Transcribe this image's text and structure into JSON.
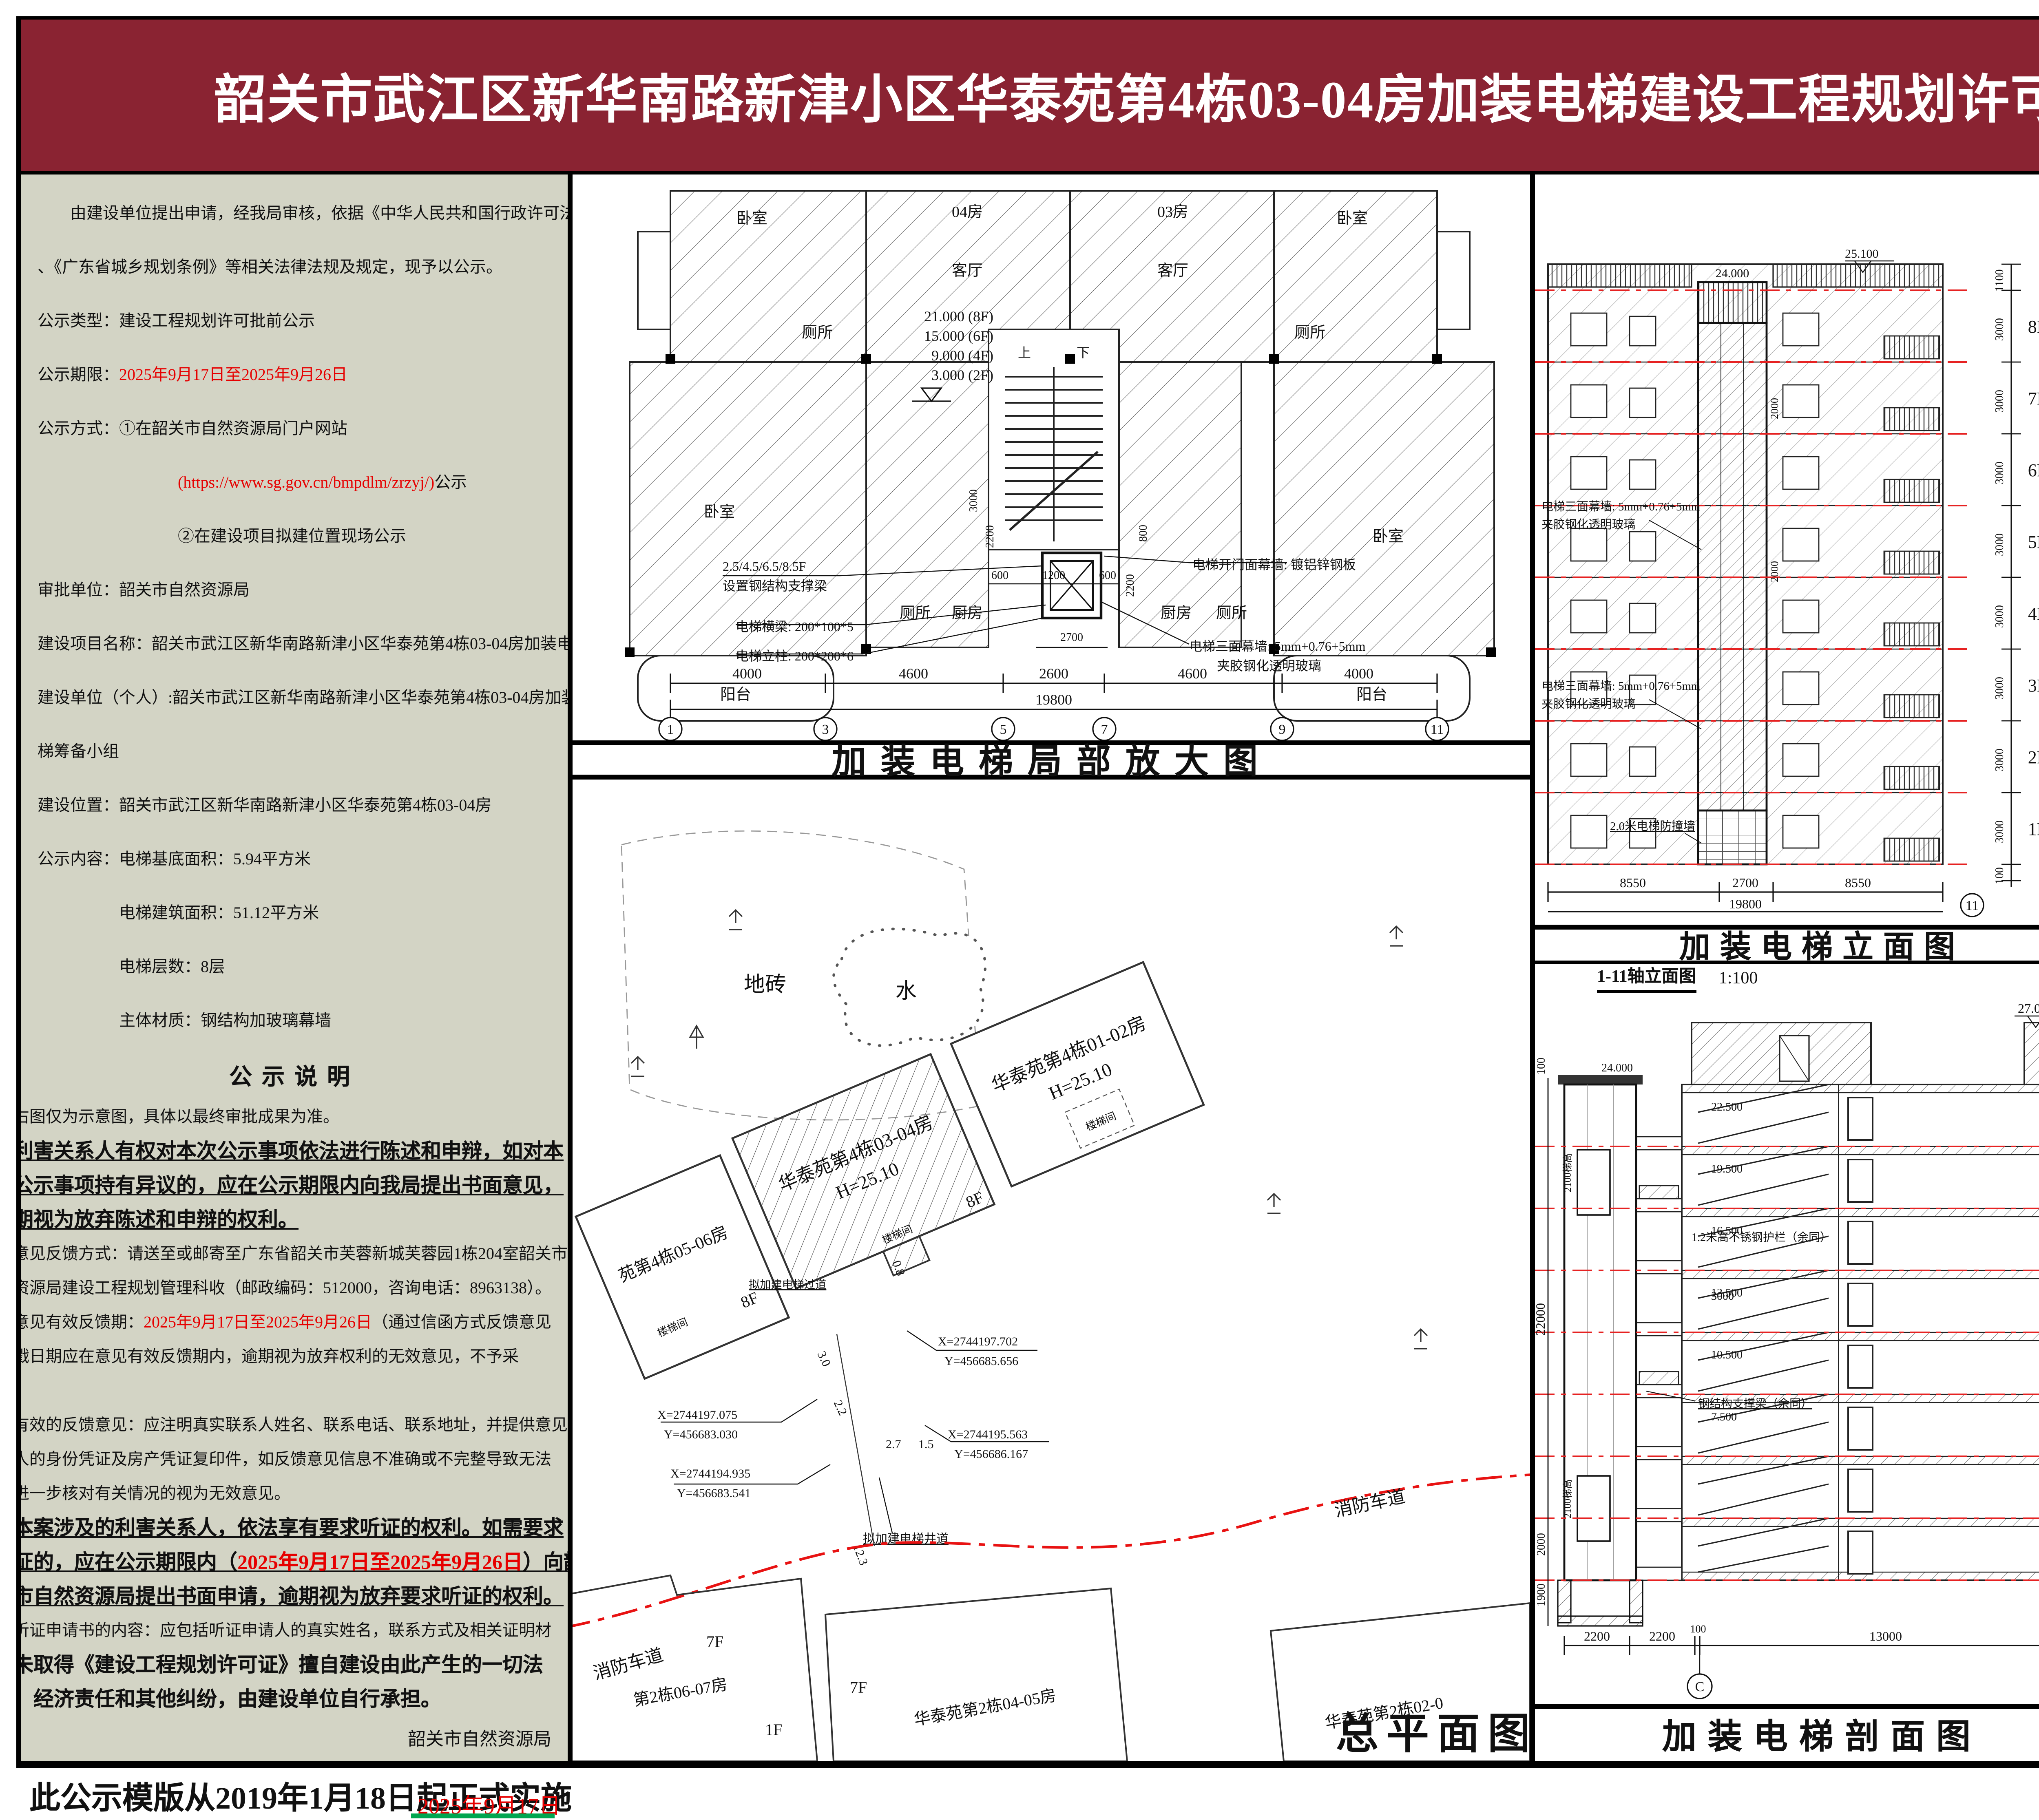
{
  "banner": {
    "title": "韶关市武江区新华南路新津小区华泰苑第4栋03-04房加装电梯建设工程规划许可批前公示(一)"
  },
  "notice": {
    "p1a": "由建设单位提出申请，经我局审核，依据《中华人民共和国行政许可法》",
    "p1b": "、《广东省城乡规划条例》等相关法律法规及规定，现予以公示。",
    "type": "公示类型：建设工程规划许可批前公示",
    "period_label": "公示期限：",
    "period_date": "2025年9月17日至2025年9月26日",
    "method1": "公示方式：①在韶关市自然资源局门户网站",
    "method_url": "(https://www.sg.gov.cn/bmpdlm/zrzyj/)",
    "method_url_tail": "公示",
    "method2": "②在建设项目拟建位置现场公示",
    "approval": "审批单位：韶关市自然资源局",
    "project": "建设项目名称：韶关市武江区新华南路新津小区华泰苑第4栋03-04房加装电梯",
    "owner1": "建设单位（个人）:韶关市武江区新华南路新津小区华泰苑第4栋03-04房加装电",
    "owner2": "梯筹备小组",
    "location": "建设位置：韶关市武江区新华南路新津小区华泰苑第4栋03-04房",
    "content1": "公示内容：电梯基底面积：5.94平方米",
    "content2": "电梯建筑面积：51.12平方米",
    "content3": "电梯层数：8层",
    "content4": "主体材质：钢结构加玻璃幕墙"
  },
  "statement": {
    "heading": "公示说明",
    "s1": "右图仅为示意图，具体以最终审批成果为准。",
    "s2a": "利害关系人有权对本次公示事项依法进行陈述和申辩，如对本",
    "s2b": "公示事项持有异议的，应在公示期限内向我局提出书面意见，",
    "s2c": "期视为放弃陈述和申辩的权利。",
    "s3a": "意见反馈方式：请送至或邮寄至广东省韶关市芙蓉新城芙蓉园1栋204室韶关市",
    "s3b": "资源局建设工程规划管理科收（邮政编码：512000，咨询电话：8963138）。",
    "s4_label": "意见有效反馈期：",
    "s4_date": "2025年9月17日至2025年9月26日",
    "s4_tail": "（通过信函方式反馈意见",
    "s4b": "戳日期应在意见有效反馈期内，逾期视为放弃权利的无效意见，不予采",
    "s4c": "。",
    "s5a": "有效的反馈意见：应注明真实联系人姓名、联系电话、联系地址，并提供意见",
    "s5b": "人的身份凭证及房产凭证复印件，如反馈意见信息不准确或不完整导致无法",
    "s5c": "进一步核对有关情况的视为无效意见。",
    "s6a": "本案涉及的利害关系人，依法享有要求听证的权利。如需要求",
    "s6b_pre": "证的，应在公示期限内（",
    "s6b_date": "2025年9月17日至2025年9月26日",
    "s6b_tail": "）向韶",
    "s6c": "市自然资源局提出书面申请，逾期视为放弃要求听证的权利。",
    "s7": "听证申请书的内容：应包括听证申请人的真实姓名，联系方式及相关证明材",
    "s8a": "未取得《建设工程规划许可证》擅自建设由此产生的一切法",
    "s8b": "　经济责任和其他纠纷，由建设单位自行承担。",
    "sign": "韶关市自然资源局"
  },
  "floor_plan": {
    "title": "加装电梯局部放大图",
    "rooms": {
      "bed_tl": "卧室",
      "unit04": "04房",
      "unit03": "03房",
      "living_l": "客厅",
      "living_r": "客厅",
      "bed_tr": "卧室",
      "wc_tl": "厕所",
      "wc_tr": "厕所",
      "bed_ml": "卧室",
      "bed_mr": "卧室",
      "wc_bl": "厕所",
      "kitchen_l": "厨房",
      "kitchen_r": "厨房",
      "wc_br": "厕所",
      "balcony_l": "阳台",
      "balcony_r": "阳台"
    },
    "levels": [
      "21.000 (8F)",
      "15.000 (6F)",
      "9.000 (4F)",
      "3.000 (2F)"
    ],
    "stair_up": "上",
    "stair_down": "下",
    "ann_floors": "2.5/4.5/6.5/8.5F",
    "ann_floors2": "设置钢结构支撑梁",
    "ann_door": "电梯开门面幕墙: 镀铝锌钢板",
    "ann_beam": "电梯横梁: 200*100*5",
    "ann_col": "电梯立柱: 200*200*6",
    "ann_glass1": "电梯三面幕墙: 5mm+0.76+5mm",
    "ann_glass2": "夹胶钢化透明玻璃",
    "dim_600a": "600",
    "dim_1200": "1200",
    "dim_600b": "600",
    "dim_2700": "2700",
    "dim_2200l": "2200",
    "dim_2200r": "2200",
    "dim_3000": "3000",
    "dim_800": "800",
    "axis_dims": [
      "4000",
      "4600",
      "2600",
      "4600",
      "4000"
    ],
    "total": "19800",
    "axes": [
      "1",
      "3",
      "5",
      "7",
      "9",
      "11"
    ]
  },
  "elevation": {
    "title": "加装电梯立面图",
    "subtitle": "1-11轴立面图",
    "scale": "1:100",
    "shaft_top": "24.000",
    "roof": "25.100",
    "flags": [
      "25.100",
      "24.000",
      "21.000",
      "18.000",
      "15.000",
      "12.000",
      "9.000",
      "6.000",
      "3.000",
      "±0.000",
      "-0.100"
    ],
    "floors": [
      "8F",
      "7F",
      "6F",
      "5F",
      "4F",
      "3F",
      "2F",
      "1F"
    ],
    "dim_1100": "1100",
    "dim_3000": "3000",
    "dim_100": "100",
    "dim_2000": "2000",
    "glass1": "电梯三面幕墙: 5mm+0.76+5mm",
    "glass2": "夹胶钢化透明玻璃",
    "wall": "2.0米电梯防撞墙",
    "bottom_dims": [
      "8550",
      "2700",
      "8550"
    ],
    "total": "19800",
    "axis": "11"
  },
  "section": {
    "title": "加装电梯剖面图",
    "top": "27.000",
    "left_top": "24.000",
    "landings": [
      "22.500",
      "19.500",
      "16.500",
      "13.500",
      "10.500",
      "7.500"
    ],
    "d1100": "1100",
    "d3000": "3000",
    "d100": "100",
    "l100": "100",
    "l22000": "22000",
    "l2000": "2000",
    "l1900": "1900",
    "car_dim": "2100梯高",
    "ann_beam": "钢结构支撑梁（余同）",
    "ann_rail": "1.2米高不锈钢护栏（余同）",
    "ann_3000": "3000",
    "bottom_dims": [
      "2200",
      "2200",
      "100",
      "13000",
      "100"
    ],
    "axes": [
      "C",
      "A"
    ]
  },
  "site_plan": {
    "title": "总平面图",
    "ground": "地砖",
    "water": "水",
    "b0102": "华泰苑第4栋01-02房",
    "b0102_h": "H=25.10",
    "b0304": "华泰苑第4栋03-04房",
    "b0304_h": "H=25.10",
    "b0506": "苑第4栋05-06房",
    "b0607": "第2栋06-07房",
    "b0405": "华泰苑第2栋04-05房",
    "b0201": "华泰苑第2栋02-0",
    "stair": "楼梯间",
    "f8": "8F",
    "f7": "7F",
    "f1": "1F",
    "fire_lane": "消防车道",
    "corridor": "拟加建电梯过道",
    "shaft": "拟加建电梯井道",
    "coords": [
      {
        "x": "X=2744197.702",
        "y": "Y=456685.656"
      },
      {
        "x": "X=2744197.075",
        "y": "Y=456683.030"
      },
      {
        "x": "X=2744195.563",
        "y": "Y=456686.167"
      },
      {
        "x": "X=2744194.935",
        "y": "Y=456683.541"
      }
    ],
    "dims": {
      "d30": "3.0",
      "d22": "2.2",
      "d27": "2.7",
      "d15": "1.5",
      "d123": "12.3",
      "d08": "0.8"
    }
  },
  "compass": {
    "north": "N",
    "ticks": [
      "0",
      "5",
      "10",
      "20m"
    ]
  },
  "map": {
    "baogailing": "宝盖岭",
    "hotel1": "韶关曼哈顿国",
    "hotel2": "际酒店附近",
    "xinxing": "新兴路",
    "fukang": "富康广场",
    "gongyezhong": "工业中路",
    "gongyedong": "工业东路",
    "huatai": "华泰花园",
    "project": "项目位置",
    "baiwei": "佰味楼附近",
    "yihua": "怡华路",
    "moer": "关摩尔城",
    "shiji": "世纪购物"
  },
  "legend": {
    "main": "新建电梯主体",
    "land": "新建电梯所占用地",
    "building": "新建电梯所在建筑",
    "dim": "尺寸标注",
    "coord": "坐标标注",
    "dim_sample": "2.35",
    "coord_x": "X=43337.034",
    "coord_y": "Y=58209.521"
  },
  "notes": {
    "n1": "1、新建电梯位置如图所示。",
    "n2": "2、图中标注单位为米。"
  },
  "footer": {
    "template": "此公示模版从2019年1月18日起正式实施",
    "date": "2025年9月17日",
    "supervisor": "监制单位：韶关市自然资源局"
  }
}
